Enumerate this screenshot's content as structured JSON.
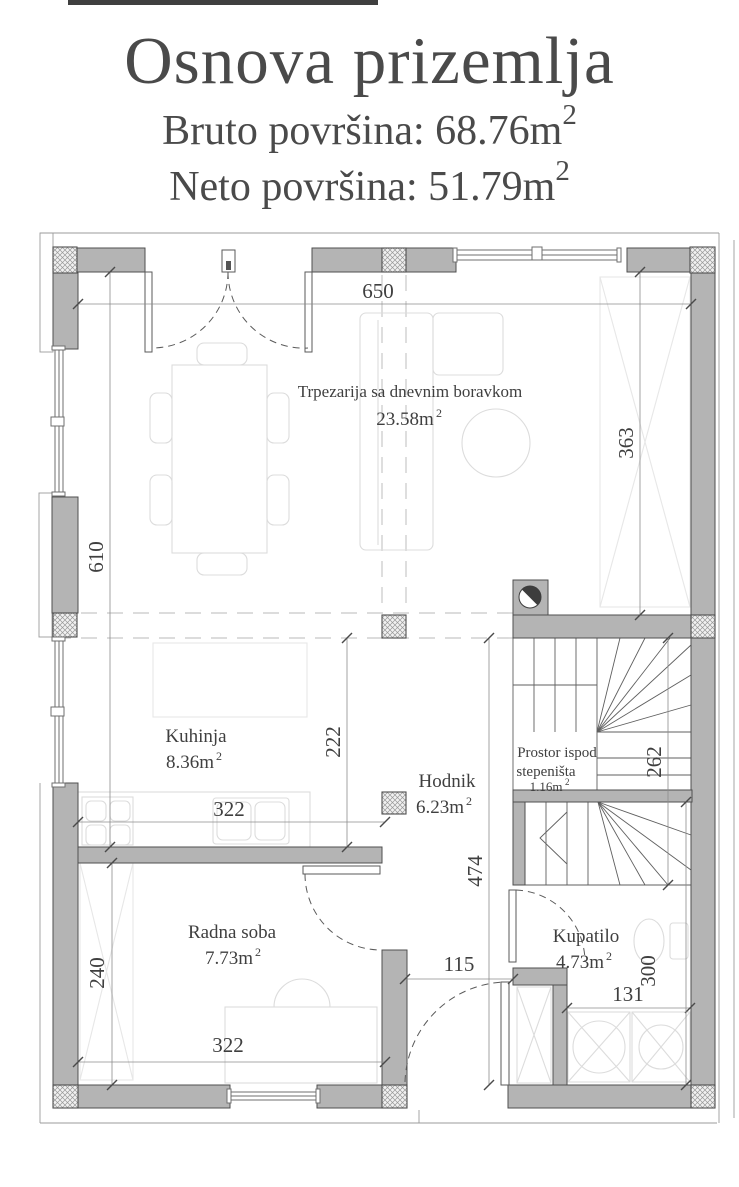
{
  "header": {
    "title": "Osnova prizemlja",
    "bruto_text": "Bruto površina: 68.76m",
    "neto_text": "Neto površina: 51.79m",
    "sup": "2"
  },
  "rooms": {
    "living": {
      "name": "Trpezarija sa dnevnim boravkom",
      "area": "23.58m"
    },
    "kitchen": {
      "name": "Kuhinja",
      "area": "8.36m"
    },
    "hall": {
      "name": "Hodnik",
      "area": "6.23m"
    },
    "understairs": {
      "name_line1": "Prostor ispod",
      "name_line2": "stepeništa",
      "area": "1.16m"
    },
    "study": {
      "name": "Radna soba",
      "area": "7.73m"
    },
    "bathroom": {
      "name": "Kupatilo",
      "area": "4.73m"
    }
  },
  "dimensions": {
    "living_width": "650",
    "living_height": "610",
    "wardrobe_height": "363",
    "kitchen_depth": "222",
    "kitchen_width": "322",
    "hall_length": "474",
    "stairs_length": "262",
    "entry_width": "115",
    "bathroom_width": "131",
    "bathroom_height": "300",
    "study_height": "240",
    "study_width": "322"
  },
  "colors": {
    "background": "#ffffff",
    "wall_fill": "#b4b4b4",
    "wall_outline": "#4f4f4f",
    "dimension_line": "#8c8c8c",
    "text": "#3f3f3f",
    "furniture_line": "#dcdcdc",
    "projection_dash": "#c7c7c7"
  }
}
